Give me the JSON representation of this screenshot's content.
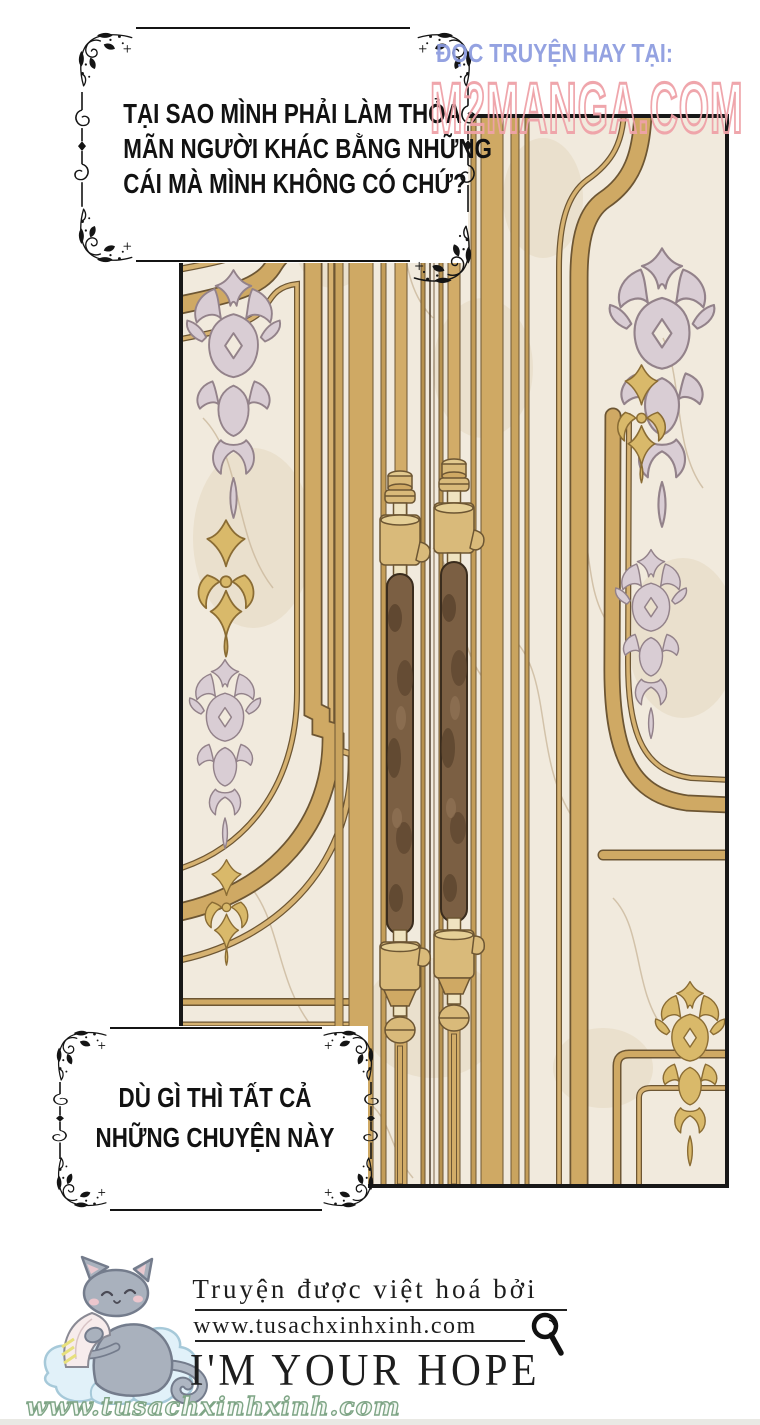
{
  "watermark": {
    "prefix": "ĐỌC TRUYỆN HAY TẠI:",
    "site": "M2MANGA.COM",
    "prefix_color": "#8b9bdf",
    "site_color": "#efa2a8"
  },
  "bubbles": {
    "top": {
      "lines": [
        "TẠI SAO MÌNH PHẢI LÀM THỎA",
        "MÃN NGƯỜI KHÁC BẰNG NHỮNG",
        "CÁI MÀ MÌNH KHÔNG CÓ CHỨ?"
      ]
    },
    "bottom": {
      "lines": [
        "DÙ GÌ THÌ TẤT CẢ",
        "NHỮNG CHUYỆN NÀY"
      ]
    }
  },
  "credits": {
    "line1": "Truyện được việt hoá bởi",
    "url": "www.tusachxinhxinh.com",
    "tagline": "I'M YOUR HOPE",
    "url_script": "www.tusachxinhxinh.com",
    "icons": [
      "magnifier-icon",
      "cat-mascot-icon",
      "cloud-icon"
    ]
  },
  "artwork": {
    "description": "ornate gilded palace double doors with marble panels, damask ornaments and long bar handles",
    "colors": {
      "gold": "#cfa964",
      "gold_dark": "#6d5633",
      "marble": "#f1eadd",
      "damask_lavender": "#d9cdd4",
      "handle_brown": "#7b5f43",
      "panel_border": "#181818"
    }
  }
}
